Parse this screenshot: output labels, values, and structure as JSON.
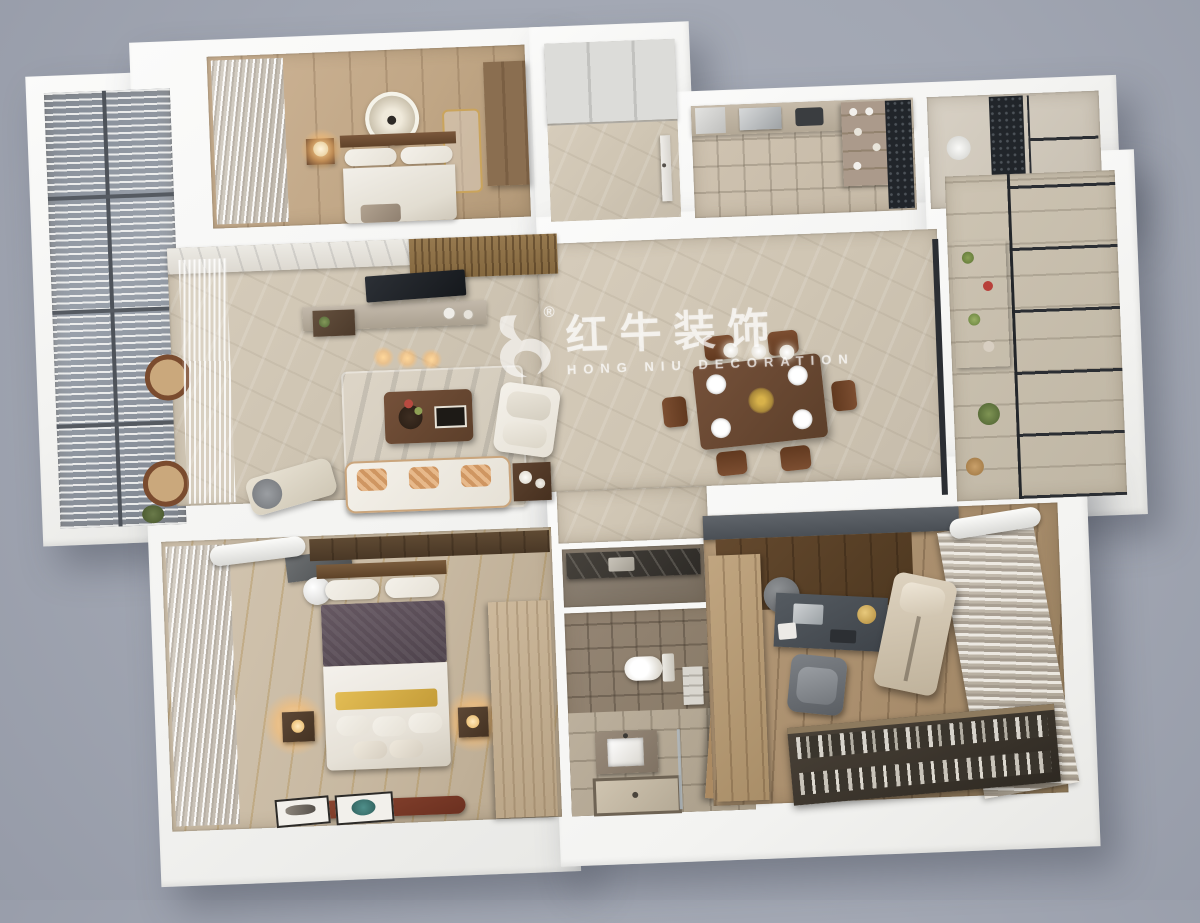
{
  "watermark": {
    "logo": "bull-logo",
    "registered_mark": "®",
    "brand_cn": "红牛装饰",
    "brand_en": "HONG NIU DECORATION"
  },
  "palette": {
    "background": "#a2a7b3",
    "wall_white": "#f7f7f5",
    "marble_floor": "#cfc5b3",
    "light_wood_floor": "#c8b9a2",
    "dark_wood_furniture": "#6a4a31",
    "bathroom_tile": "#8a7c6d",
    "glass_panel": "#8b929c",
    "window_frame_black": "#2b2e33",
    "sofa_cream": "#efe9df",
    "pillow_orange": "#c98a5c",
    "bed_blanket_mauve": "#5e5158",
    "bench_rust": "#7d3a28",
    "lamp_glow": "#ffd79a",
    "study_cabinet_gray": "#565b61",
    "watermark_white": "#ffffff"
  },
  "scene": {
    "type": "3d-rendered-apartment-floorplan-top-view",
    "rooms": [
      {
        "id": "left-balcony",
        "label": "Left balcony"
      },
      {
        "id": "second-bedroom",
        "label": "Second bedroom"
      },
      {
        "id": "entry-foyer",
        "label": "Entry foyer"
      },
      {
        "id": "kitchen",
        "label": "Kitchen"
      },
      {
        "id": "kitchen-balcony",
        "label": "Kitchen balcony"
      },
      {
        "id": "living-room",
        "label": "Living room"
      },
      {
        "id": "dining-room",
        "label": "Dining room"
      },
      {
        "id": "right-balcony",
        "label": "Right balcony"
      },
      {
        "id": "corridor",
        "label": "Corridor"
      },
      {
        "id": "utility-room",
        "label": "Utility room"
      },
      {
        "id": "bathroom",
        "label": "Bathroom"
      },
      {
        "id": "master-bedroom",
        "label": "Master bedroom"
      },
      {
        "id": "study",
        "label": "Study room"
      }
    ]
  }
}
